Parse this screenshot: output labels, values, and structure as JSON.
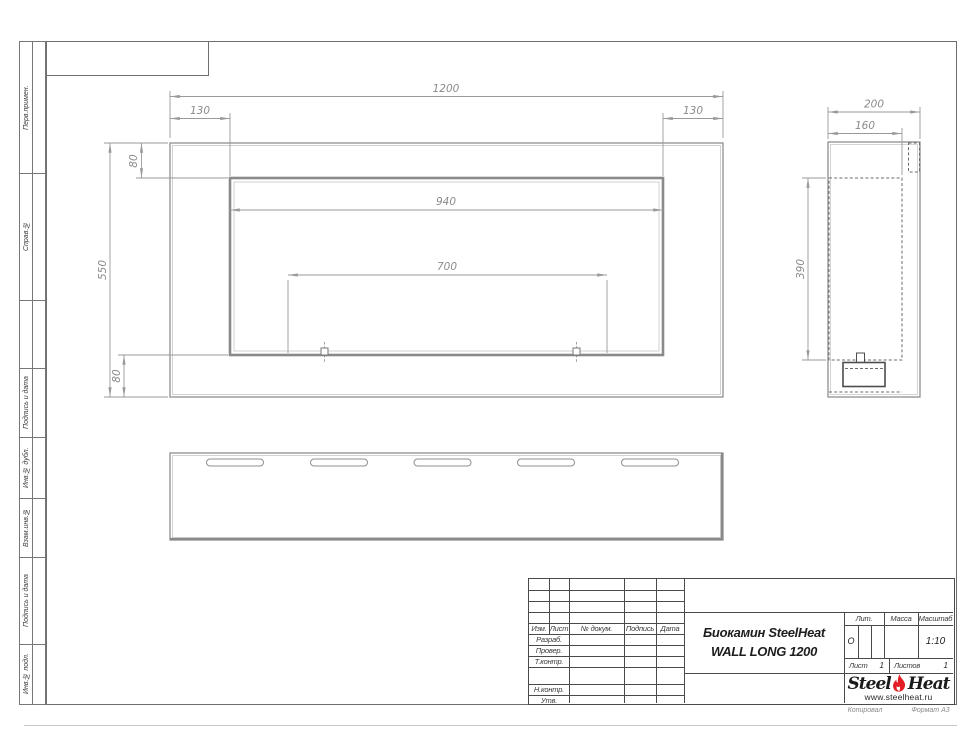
{
  "document": {
    "product_title_line1": "Биокамин SteelHeat",
    "product_title_line2": "WALL LONG 1200"
  },
  "sidebar": {
    "items": [
      {
        "label": "Перв.примен."
      },
      {
        "label": "Справ.№"
      },
      {
        "label": "Подпись и дата"
      },
      {
        "label": "Инв.№ дубл."
      },
      {
        "label": "Взам.инв.№"
      },
      {
        "label": "Подпись и дата"
      },
      {
        "label": "Инв.№ подл."
      }
    ]
  },
  "title_block": {
    "col_izm": "Изм.",
    "col_list": "Лист",
    "col_doc": "№ докум.",
    "col_sign": "Подпись",
    "col_date": "Дата",
    "row_developed": "Разраб.",
    "row_checked": "Провер.",
    "row_tcontrol": "Т.контр.",
    "row_ncontrol": "Н.контр.",
    "row_approved": "Утв.",
    "lit_label": "Лит.",
    "lit_value": "О",
    "mass_label": "Масса",
    "scale_label": "Масштаб",
    "scale_value": "1:10",
    "sheet_label": "Лист",
    "sheet_value": "1",
    "sheets_label": "Листов",
    "sheets_value": "1"
  },
  "logo": {
    "steel": "Steel",
    "heat": "Heat",
    "website": "www.steelheat.ru"
  },
  "footer": {
    "copied_by": "Копировал",
    "format": "Формат А3"
  },
  "dimensions": {
    "front_total_width": "1200",
    "front_left_inset": "130",
    "front_right_inset": "130",
    "front_top_inset": "80",
    "front_height": "550",
    "front_bottom_inset": "80",
    "front_opening_width": "940",
    "front_burner_span": "700",
    "side_depth": "200",
    "side_inner_depth": "160",
    "side_opening_height": "390"
  },
  "colors": {
    "flame_red": "#e31e24",
    "drawing_line": "#8f8f8f",
    "dim_text": "#8a8a8a"
  }
}
